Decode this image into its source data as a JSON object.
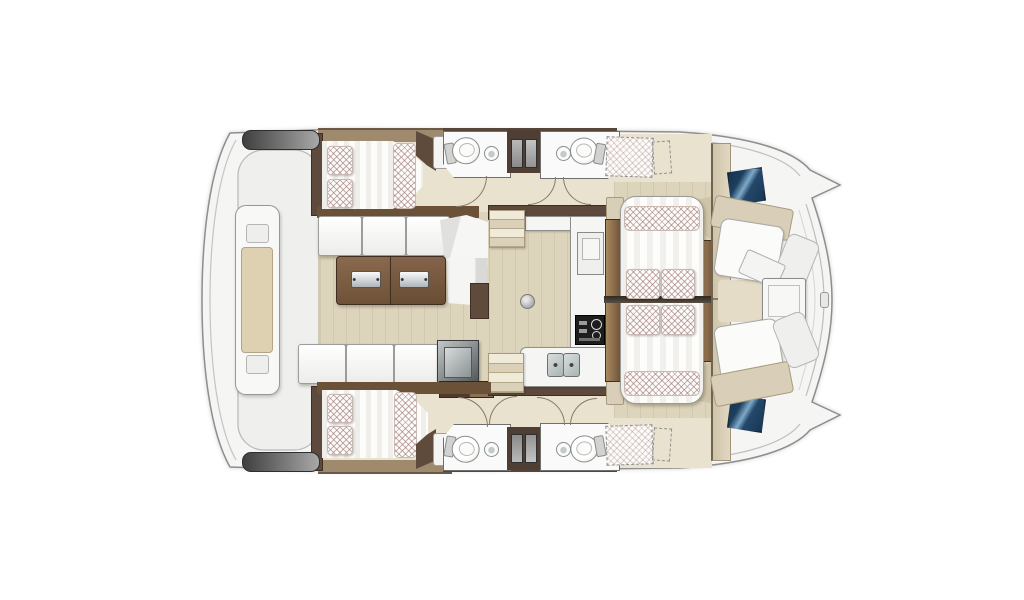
{
  "diagram": {
    "type": "floor-plan",
    "subject": "sailing catamaran interior layout, top-down view, bow pointing right",
    "areas": [
      {
        "id": "aft-platform",
        "label": "aft platform with central console and lockers"
      },
      {
        "id": "port-aft-cabin",
        "label": "port double berth cabin with pillows"
      },
      {
        "id": "starboard-aft-cabin",
        "label": "starboard double berth cabin with pillows"
      },
      {
        "id": "port-heads",
        "label": "port side bathrooms with toilet and washbasin"
      },
      {
        "id": "starboard-heads",
        "label": "starboard side bathrooms with toilet and washbasin"
      },
      {
        "id": "salon",
        "label": "salon with corner sofa, chaise and folding cocktail table"
      },
      {
        "id": "galley",
        "label": "galley with double sink, stove and fridge"
      },
      {
        "id": "daybed",
        "label": "convertible daybed lounge with four cushions"
      },
      {
        "id": "forward-cockpit",
        "label": "forward cockpit with facing benches and table"
      },
      {
        "id": "foredeck",
        "label": "foredeck with two dark glass deck hatches"
      },
      {
        "id": "forepeaks",
        "label": "forepeak berths shown dashed as optional"
      }
    ],
    "counts": {
      "double_beds": 2,
      "daybeds": 1,
      "toilets": 4,
      "washbasins": 4,
      "galley_sinks": 2,
      "stoves": 1,
      "tables": 2,
      "deck_hatches": 2,
      "companionway_stairs": 2,
      "door_swings": 7
    }
  },
  "palette": {
    "bg": "#ffffff",
    "hull_fill": "#f5f5f4",
    "hull_outline": "#8e8e8e",
    "contour": "#c4c4c4",
    "deck_recess": "#efefed",
    "floor_wood": "#ddd4bc",
    "floor_corridor": "#e9e2cf",
    "wood_dark": "#5d4a3c",
    "wood_mid": "#8a6a4e",
    "tan_wall": "#a08a6d",
    "beige_trim": "#d9cfb8",
    "counter_white": "#f5f5f4",
    "cushion_white": "#fcfcfb",
    "hatch_line": "#96706a",
    "hatch_blue_dark": "#16324c",
    "hatch_blue_light": "#6e9cc0",
    "dark_bar": "#4f4f4f",
    "stove_black": "#1d1d1d",
    "sink_gray": "#c6cecf",
    "ottoman_dark": "#5f6668",
    "door_arc": "#8a7868"
  }
}
